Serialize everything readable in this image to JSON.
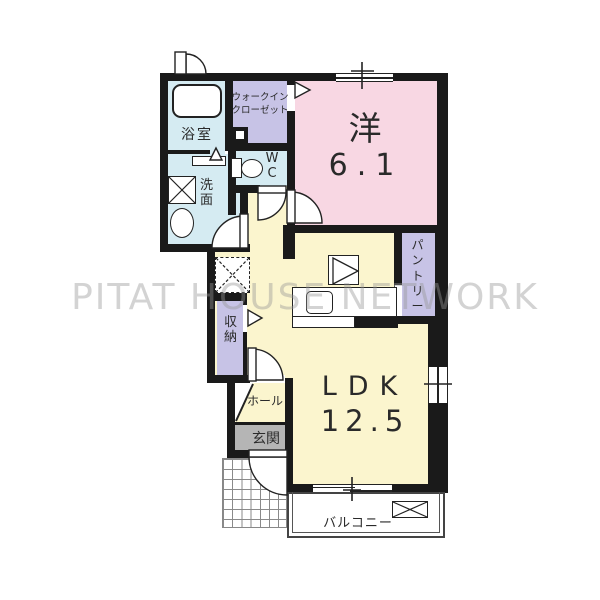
{
  "watermark": "PITAT HOUSE NETWORK",
  "rooms": {
    "western": {
      "label": "洋",
      "size": "6.1"
    },
    "ldk": {
      "label": "LDK",
      "size": "12.5"
    },
    "bathroom": {
      "label": "浴室"
    },
    "washroom": {
      "label": "洗面"
    },
    "wc": {
      "label": "WC"
    },
    "walk_in_closet": {
      "label": "ウォークインクローゼット"
    },
    "pantry": {
      "label": "パントリー"
    },
    "storage": {
      "label": "収納"
    },
    "hall": {
      "label": "ホール"
    },
    "entrance": {
      "label": "玄関"
    },
    "balcony": {
      "label": "バルコニー"
    }
  },
  "colors": {
    "wall": "#1a1a1a",
    "western_pink": "#f8d7e3",
    "ldk_yellow": "#fbf5ce",
    "closet_lavender": "#c7c3e6",
    "wet_area_blue": "#d5ebf2",
    "entrance_gray": "#b5b5b5",
    "watermark_gray": "#969696"
  },
  "icons": {
    "bathtub": "bathtub-icon",
    "washing_machine": "washing-machine-space-icon",
    "basin": "wash-basin-icon",
    "toilet": "toilet-icon",
    "refrigerator_space": "refrigerator-space-icon",
    "stove": "kitchen-appliance-icon",
    "sink": "kitchen-sink-icon",
    "outdoor_unit": "outdoor-unit-space-icon"
  }
}
